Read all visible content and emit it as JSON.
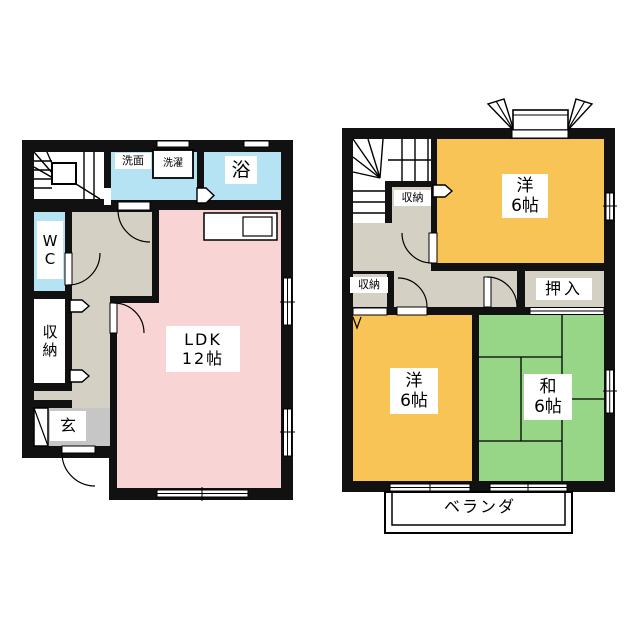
{
  "page": {
    "background": "#ffffff"
  },
  "colors": {
    "wall": "#111111",
    "water_blue": "#b5e3f4",
    "ldk_pink": "#f9d4d4",
    "western_orange": "#f8c455",
    "tatami_green": "#97d687",
    "corridor_beige": "#d4d0c3",
    "entry_gray": "#c6c6c6",
    "white_room": "#ffffff"
  },
  "floor1": {
    "labels": {
      "senmen": "洗面",
      "sentaku": "洗濯",
      "bath": "浴",
      "wc": "W\nC",
      "storage": "収\n納",
      "entry": "玄",
      "ldk": "LDK\n12帖"
    }
  },
  "floor2": {
    "labels": {
      "storage_upper": "収納",
      "western_upper": "洋\n6帖",
      "oshiire": "押入",
      "storage_lower": "収納",
      "western_lower": "洋\n6帖",
      "japanese": "和\n6帖",
      "veranda": "ベランダ"
    }
  }
}
